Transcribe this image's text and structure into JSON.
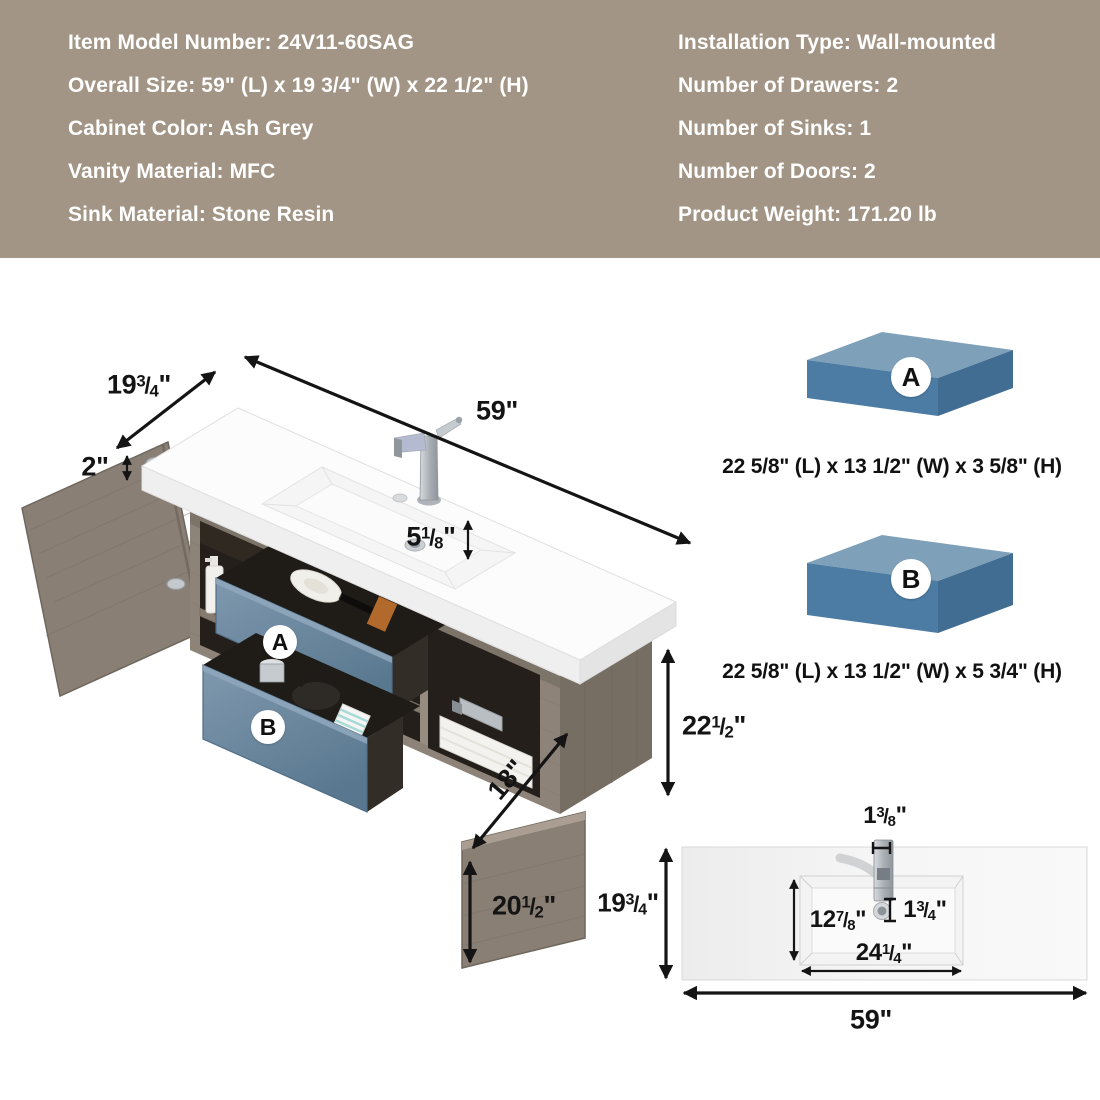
{
  "colors": {
    "banner_bg": "#a29585",
    "banner_text": "#ffffff",
    "dim": "#141414",
    "wood": "#8e8378",
    "wood_dark": "#776e63",
    "wood_edge": "#6f675d",
    "interior": "#241f1a",
    "drawer_blue": "#7191ab",
    "box_top": "#7fa0b9",
    "box_front": "#4c7ca4",
    "box_side": "#426d93"
  },
  "spec_banner": {
    "left_lines": [
      "Item Model Number: 24V11-60SAG",
      "Overall Size: 59\" (L) x 19 3/4\" (W) x 22 1/2\" (H)",
      "Cabinet Color: Ash Grey",
      "Vanity Material: MFC",
      "Sink Material: Stone Resin"
    ],
    "right_lines": [
      "Installation Type: Wall-mounted",
      "Number of Drawers: 2",
      "Number of Sinks: 1",
      "Number of Doors: 2",
      "Product Weight: 171.20 lb"
    ]
  },
  "diagram": {
    "labels": {
      "width": "19 3/4\"",
      "length": "59\"",
      "counter_thickness": "2\"",
      "basin_depth": "5 1/8\"",
      "overall_height": "22 1/2\"",
      "shelf_depth": "18\"",
      "door_height": "20 1/2\"",
      "drawer_a": "A",
      "drawer_b": "B"
    }
  },
  "drawer_boxes": [
    {
      "label": "A",
      "dimensions": "22 5/8\" (L) x 13 1/2\" (W) x 3 5/8\" (H)"
    },
    {
      "label": "B",
      "dimensions": "22 5/8\" (L) x 13 1/2\" (W) x 5 3/4\" (H)"
    }
  ],
  "top_view": {
    "labels": {
      "faucet_offset": "1 3/8\"",
      "depth": "19 3/4\"",
      "basin_width": "12 7/8\"",
      "drain_offset": "1 3/4\"",
      "basin_length": "24 1/4\"",
      "length": "59\""
    }
  }
}
